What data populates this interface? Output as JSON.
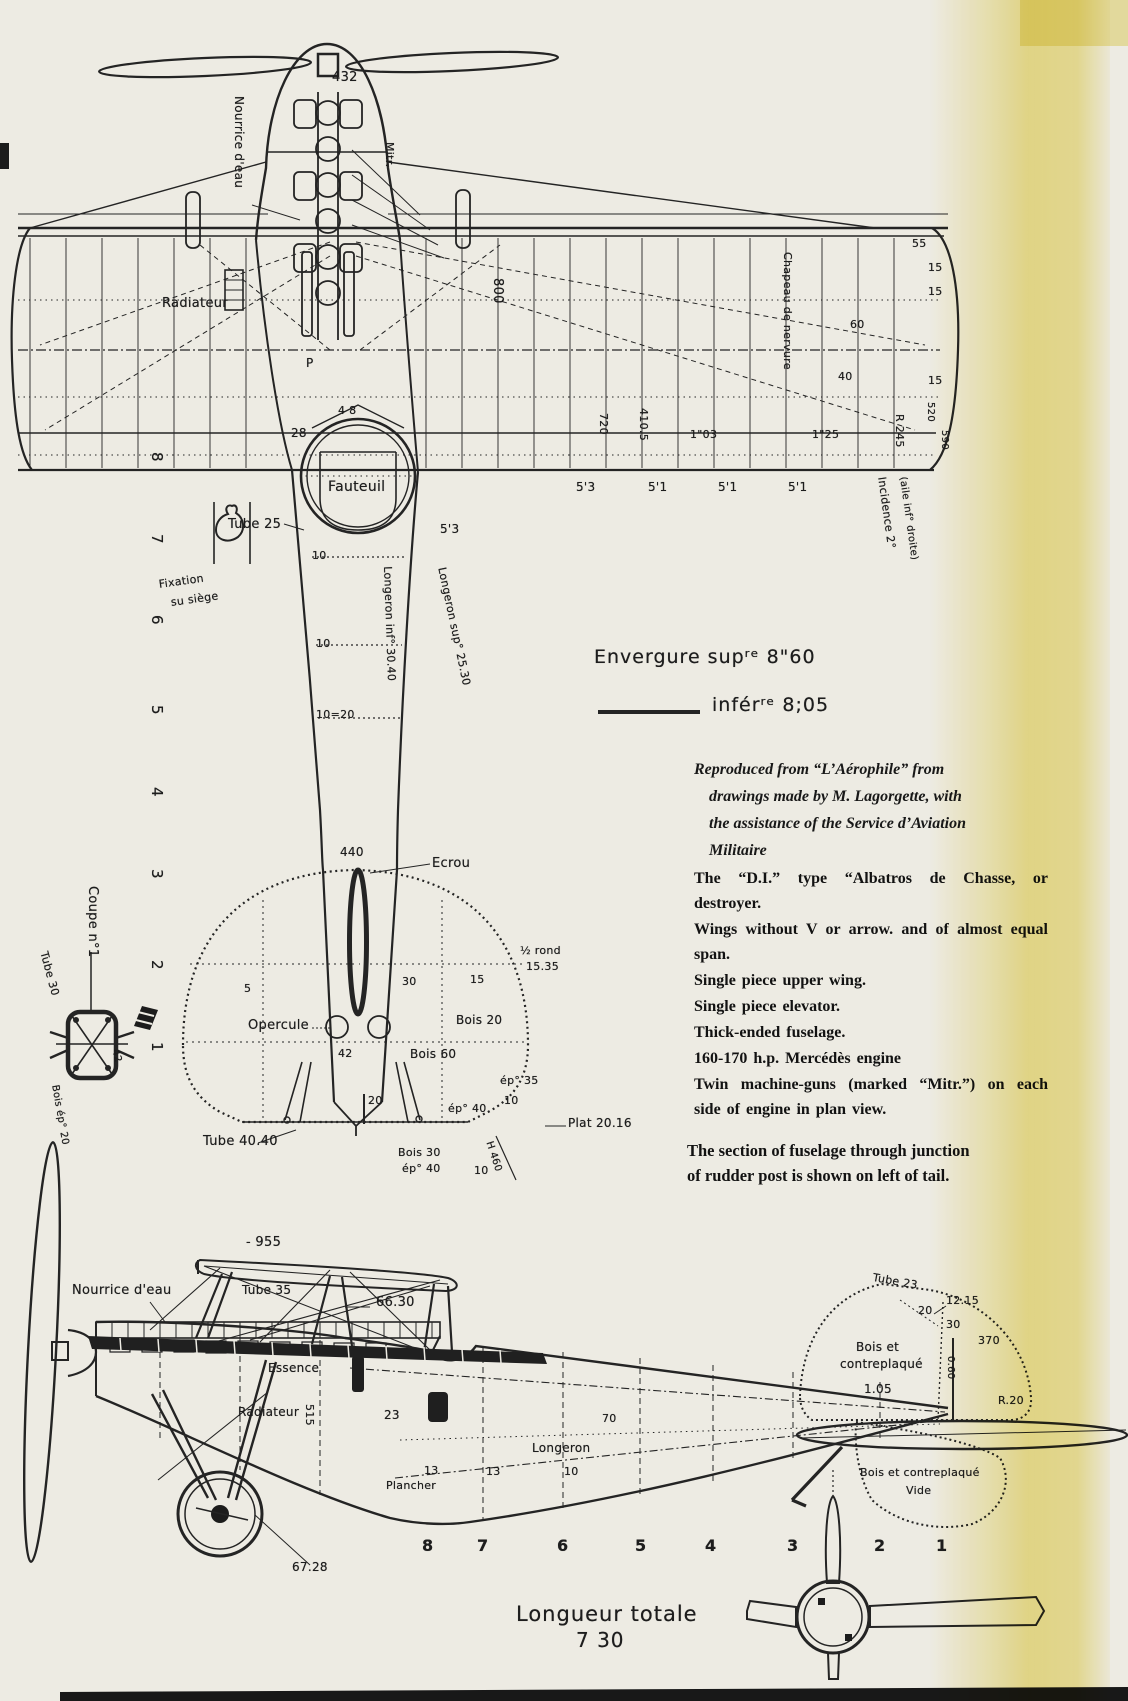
{
  "colors": {
    "paper": "#edebe3",
    "ink": "#242424",
    "stain": "#ede08a"
  },
  "top": {
    "d432": "432",
    "nourrice": "Nourrice d'eau",
    "mitr": "Mitr.",
    "radiateur": "Radiateur",
    "p": "P",
    "d48": "4 8",
    "d28": "28",
    "fauteuil": "Fauteuil",
    "tube25": "Tube 25",
    "fix1": "Fixation",
    "fix2": "su siège",
    "stations": [
      "8",
      "7",
      "6",
      "5",
      "4",
      "3",
      "2",
      "1"
    ],
    "d800": "800",
    "d720": "720",
    "d4105": "410.5",
    "d103": "1\"03",
    "d125": "1\"25",
    "r245": "R 245",
    "d520": "520",
    "d590": "590",
    "d55": "55",
    "d15a": "15",
    "d15b": "15",
    "d60": "60",
    "d40": "40",
    "d15c": "15",
    "chapeau": "Chapeau de nervure",
    "incidence1": "Incidence 2°",
    "incidence2": "(aile inf° droite)",
    "chords": [
      "5'3",
      "5'1",
      "5'1",
      "5'1"
    ],
    "chord2": "5'3",
    "d10a": "10",
    "d10b": "10",
    "d1020": "10=20",
    "d440": "440",
    "longeron_sup": "Longeron sup° 25.30",
    "longeron_inf": "Longeron inf° 30.40",
    "ecrou": "Ecrou",
    "demirond1": "½ rond",
    "demirond2": "15.35",
    "d30": "30",
    "d15d": "15",
    "d5": "5",
    "opercule": "Opercule",
    "bois20": "Bois 20",
    "bois60": "Bois 60",
    "d42": "42",
    "ep35": "ép° 35",
    "d10c": "10",
    "ep40a": "ép° 40",
    "d20": "20",
    "bois30": "Bois 30",
    "ep40b": "ép° 40",
    "d10d": "10",
    "plat": "Plat 20.16",
    "tube4040": "Tube 40.40",
    "h460": "H 460",
    "coupe": "Coupe n°1",
    "tube30": "Tube 30",
    "c42": "42",
    "boisep20": "Bois ép° 20"
  },
  "legend": {
    "sup": "Envergure  supʳᵉ    8\"60",
    "inf": "inférʳᵉ  8;05"
  },
  "credit": {
    "l1": "Reproduced from “L’Aérophile” from",
    "l2": "drawings made by M. Lagorgette, with",
    "l3": "the assistance of the Service d’Aviation",
    "l4": "Militaire"
  },
  "features": [
    "The “D.I.” type “Albatros de Chasse, or destroyer.",
    "Wings without V or arrow. and of almost equal span.",
    "Single piece upper wing.",
    "Single piece elevator.",
    "Thick-ended fuselage.",
    "160-170 h.p. Mercédès engine",
    "Twin machine-guns (marked “Mitr.”) on each side of engine in plan view."
  ],
  "note": {
    "l1": "The section of fuselage through junction",
    "l2": "of rudder post is shown on left of tail."
  },
  "side": {
    "d955": "- 955",
    "nourrice": "Nourrice d'eau",
    "tube35": "Tube 35",
    "d6630": "66.30",
    "essence": "Essence",
    "radiateur": "Radiateur",
    "d515": "515",
    "d23": "23",
    "longeron": "Longeron",
    "d70": "70",
    "d13a": "13",
    "d13b": "13",
    "d10": "10",
    "plancher": "Plancher",
    "d6728": "67.28",
    "stations": [
      "8",
      "7",
      "6",
      "5",
      "4",
      "3",
      "2",
      "1"
    ],
    "tube23": "Tube 23",
    "d20": "20",
    "d1215": "12.15",
    "d30": "30",
    "d370": "370",
    "d060": "0.60",
    "r20": "R.20",
    "bois_fin1": "Bois et",
    "bois_fin2": "contreplaqué",
    "d105": "1.05",
    "bois_rudder": "Bois et contreplaqué",
    "vide": "Vide",
    "longueur1": "Longueur totale",
    "longueur2": "7 30"
  }
}
